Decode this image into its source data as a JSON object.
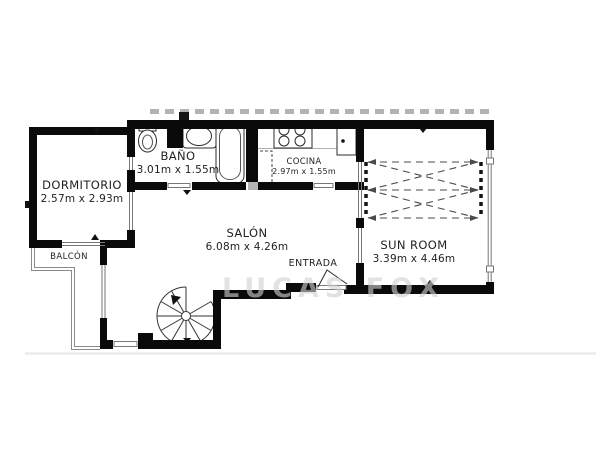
{
  "watermark": "LUCAS FOX",
  "rooms": {
    "dormitorio": {
      "name": "DORMITORIO",
      "dims": "2.57m x 2.93m"
    },
    "bano": {
      "name": "BAÑO",
      "dims": "3.01m x 1.55m"
    },
    "cocina": {
      "name": "COCINA",
      "dims": "2.97m x 1.55m"
    },
    "salon": {
      "name": "SALÓN",
      "dims": "6.08m x 4.26m"
    },
    "sunroom": {
      "name": "SUN ROOM",
      "dims": "3.39m x 4.46m"
    }
  },
  "areas": {
    "entrada": {
      "name": "ENTRADA"
    },
    "balcon": {
      "name": "BALCÓN"
    }
  },
  "colors": {
    "wall": "#0a0a0a",
    "background": "#ffffff",
    "railing": "#8a8a8a",
    "terrace_dash": "#b3b3b3",
    "watermark": "#d0d0d0",
    "label_text": "#1f1f1f"
  }
}
